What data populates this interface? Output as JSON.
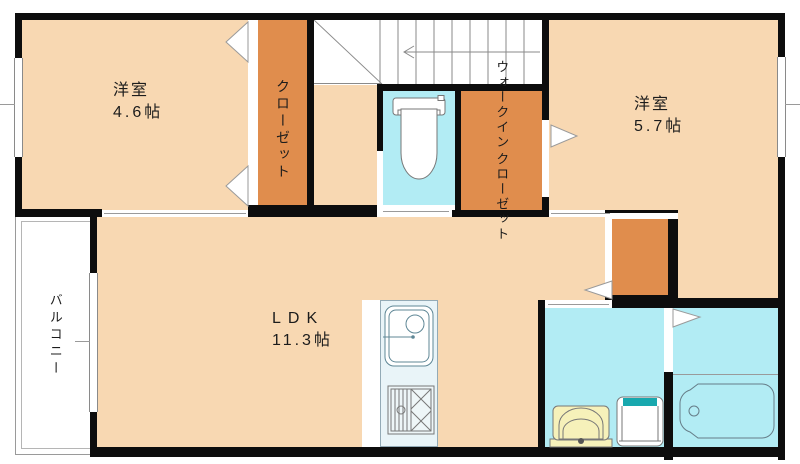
{
  "colors": {
    "wall": "#0d0d0d",
    "room": "#f8d8b2",
    "closet": "#e08d4d",
    "wet": "#b2ecf4",
    "kitchen": "#e9f4f8",
    "fixline": "#5f8796",
    "basin": "#f6f1ba",
    "teal": "#18a8ae",
    "thin": "#8a8a8a",
    "text": "#1c1c1c"
  },
  "rooms": {
    "bedroom1": {
      "name": "洋室",
      "size": "4.6帖"
    },
    "bedroom2": {
      "name": "洋室",
      "size": "5.7帖"
    },
    "ldk": {
      "name": "LDK",
      "size": "11.3帖"
    },
    "closet": {
      "label": "クローゼット"
    },
    "wic": {
      "line1": "ウォークイン",
      "line2": "クローゼット"
    },
    "balcony": {
      "label": "バルコニー"
    }
  }
}
